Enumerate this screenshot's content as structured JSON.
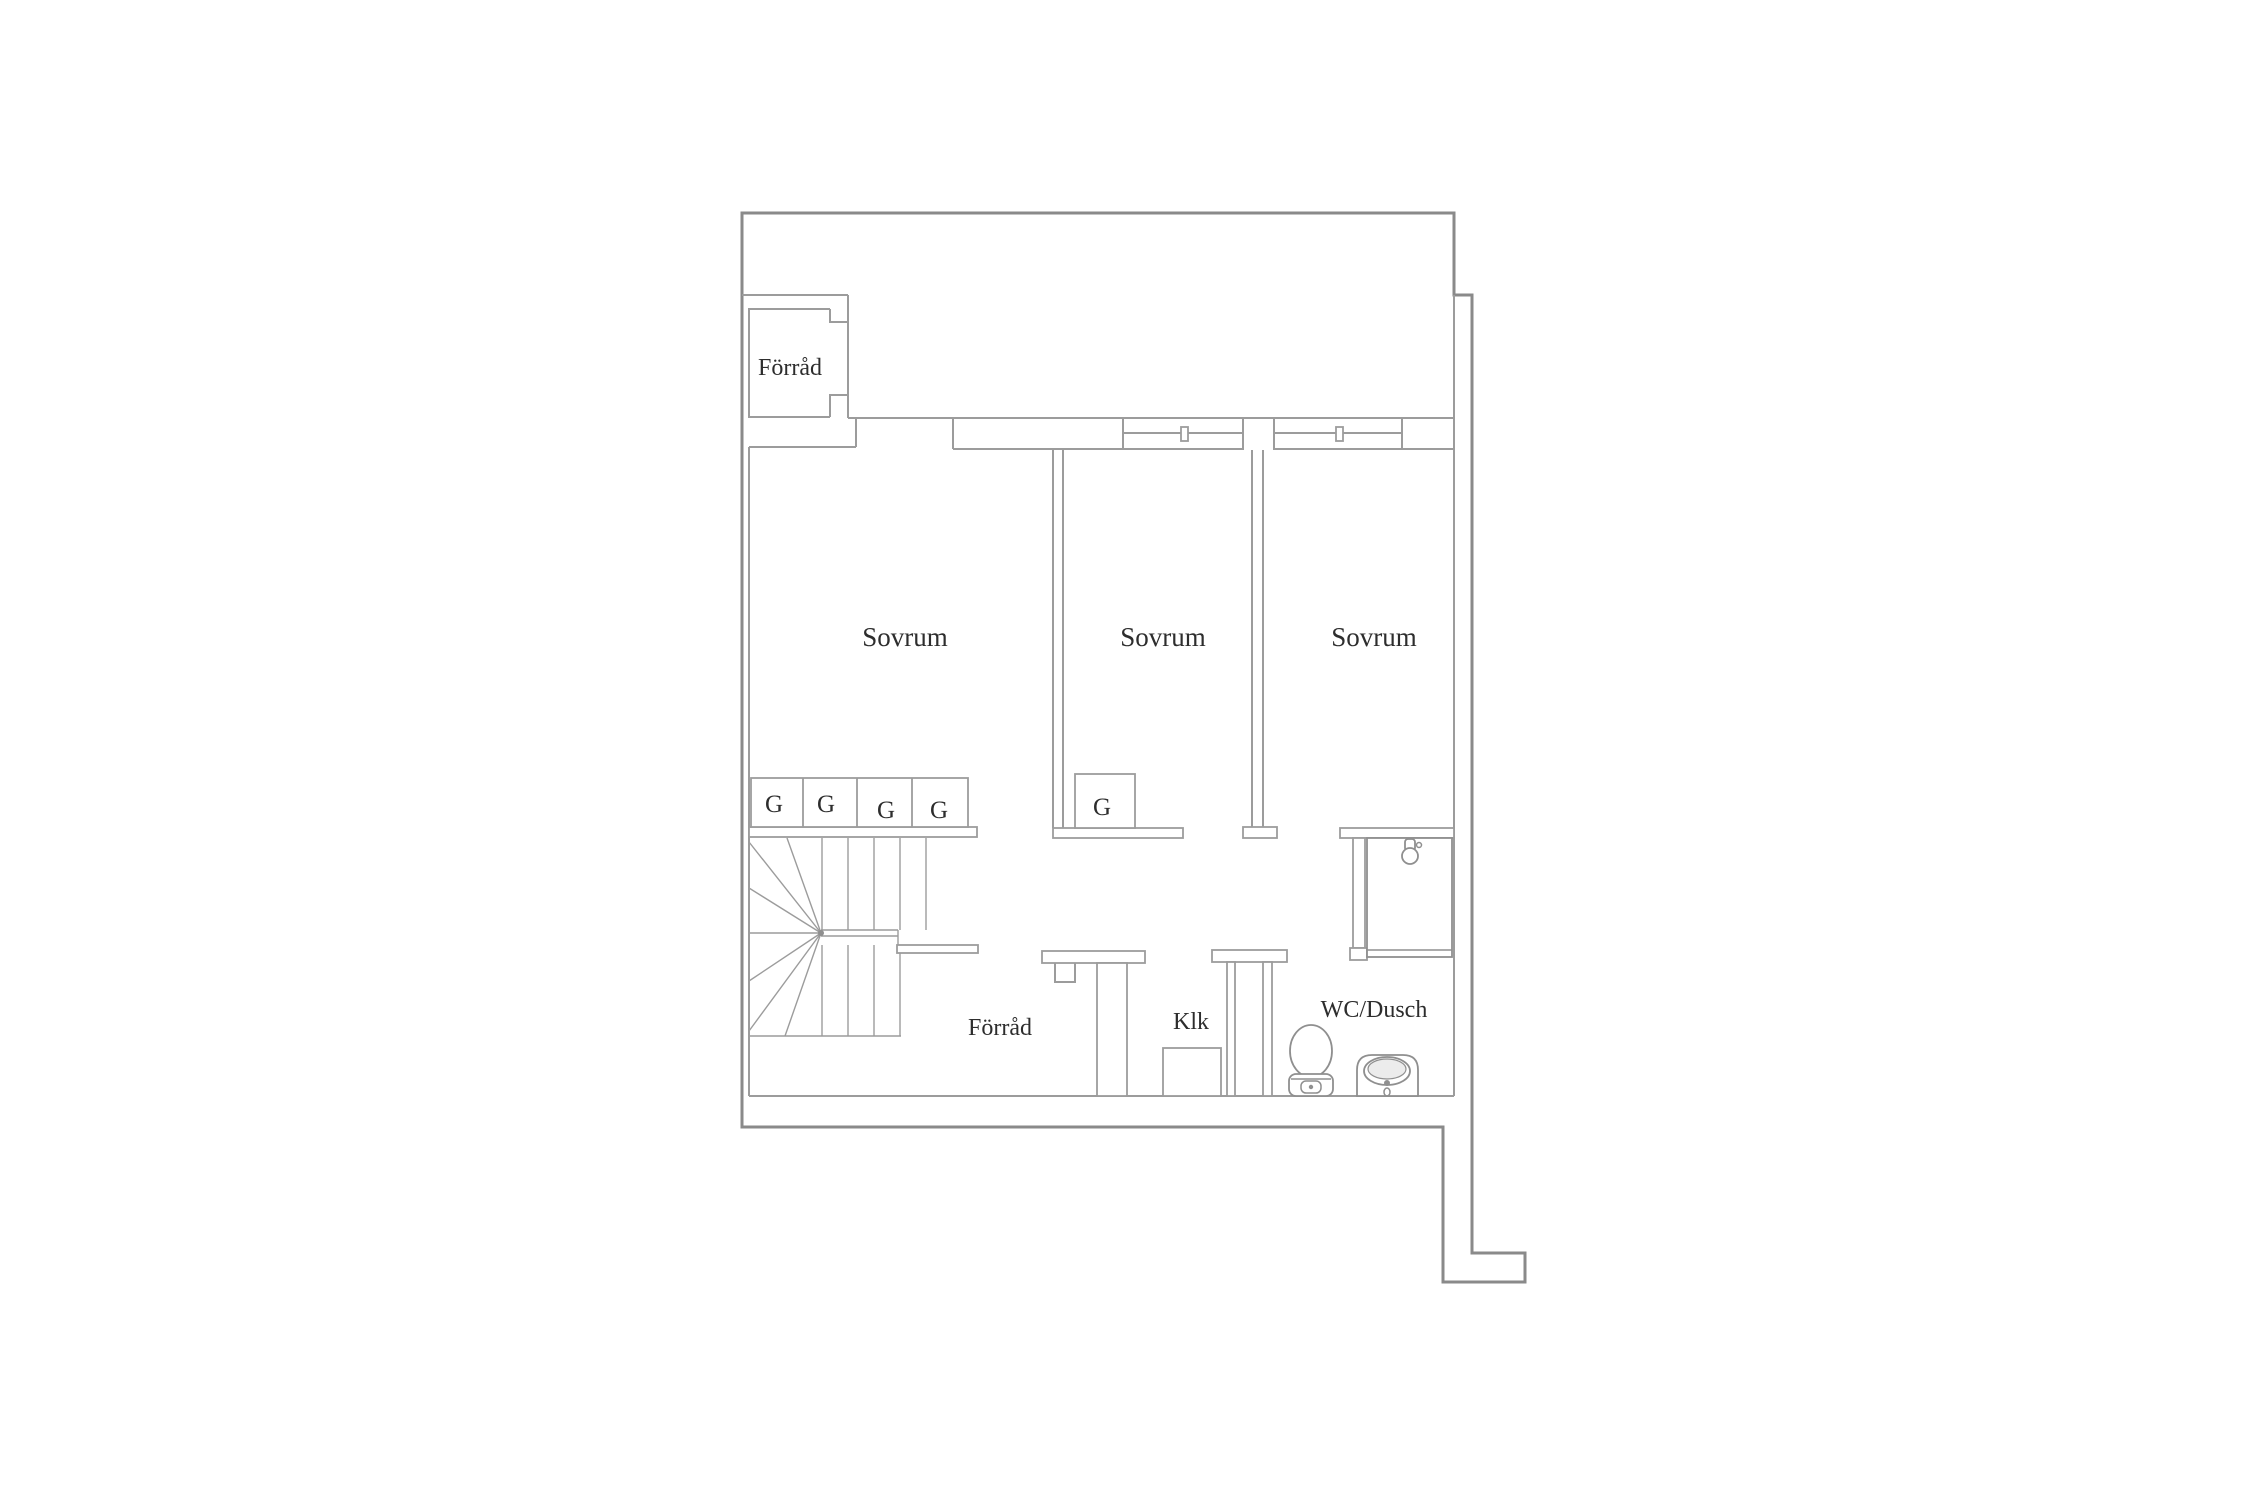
{
  "canvas": {
    "width": 2250,
    "height": 1500,
    "background": "#ffffff"
  },
  "colors": {
    "wall": "#9c9c9c",
    "outer": "#8a8a8a",
    "fixture": "#8f8f8f",
    "shade": "#ececec",
    "text": "#2d2d2d"
  },
  "floorplan": {
    "type": "apartment-floor-plan",
    "language": "Swedish",
    "rooms": [
      {
        "id": "storage-top",
        "label": "Förråd"
      },
      {
        "id": "bedroom-1",
        "label": "Sovrum"
      },
      {
        "id": "bedroom-2",
        "label": "Sovrum"
      },
      {
        "id": "bedroom-3",
        "label": "Sovrum"
      },
      {
        "id": "storage-lower",
        "label": "Förråd"
      },
      {
        "id": "walk-in-closet",
        "label": "Klk"
      },
      {
        "id": "bathroom",
        "label": "WC/Dusch"
      }
    ],
    "wardrobes": [
      {
        "id": "wardrobe-1",
        "label": "G"
      },
      {
        "id": "wardrobe-2",
        "label": "G"
      },
      {
        "id": "wardrobe-3",
        "label": "G"
      },
      {
        "id": "wardrobe-4",
        "label": "G"
      },
      {
        "id": "wardrobe-bedroom-2",
        "label": "G"
      }
    ],
    "fixtures": [
      {
        "id": "stairs",
        "kind": "winder-staircase"
      },
      {
        "id": "shower",
        "kind": "shower-cabin"
      },
      {
        "id": "toilet",
        "kind": "wc"
      },
      {
        "id": "sink",
        "kind": "washbasin"
      },
      {
        "id": "window-symbol-1",
        "kind": "window-vent"
      },
      {
        "id": "window-symbol-2",
        "kind": "window-vent"
      }
    ]
  }
}
